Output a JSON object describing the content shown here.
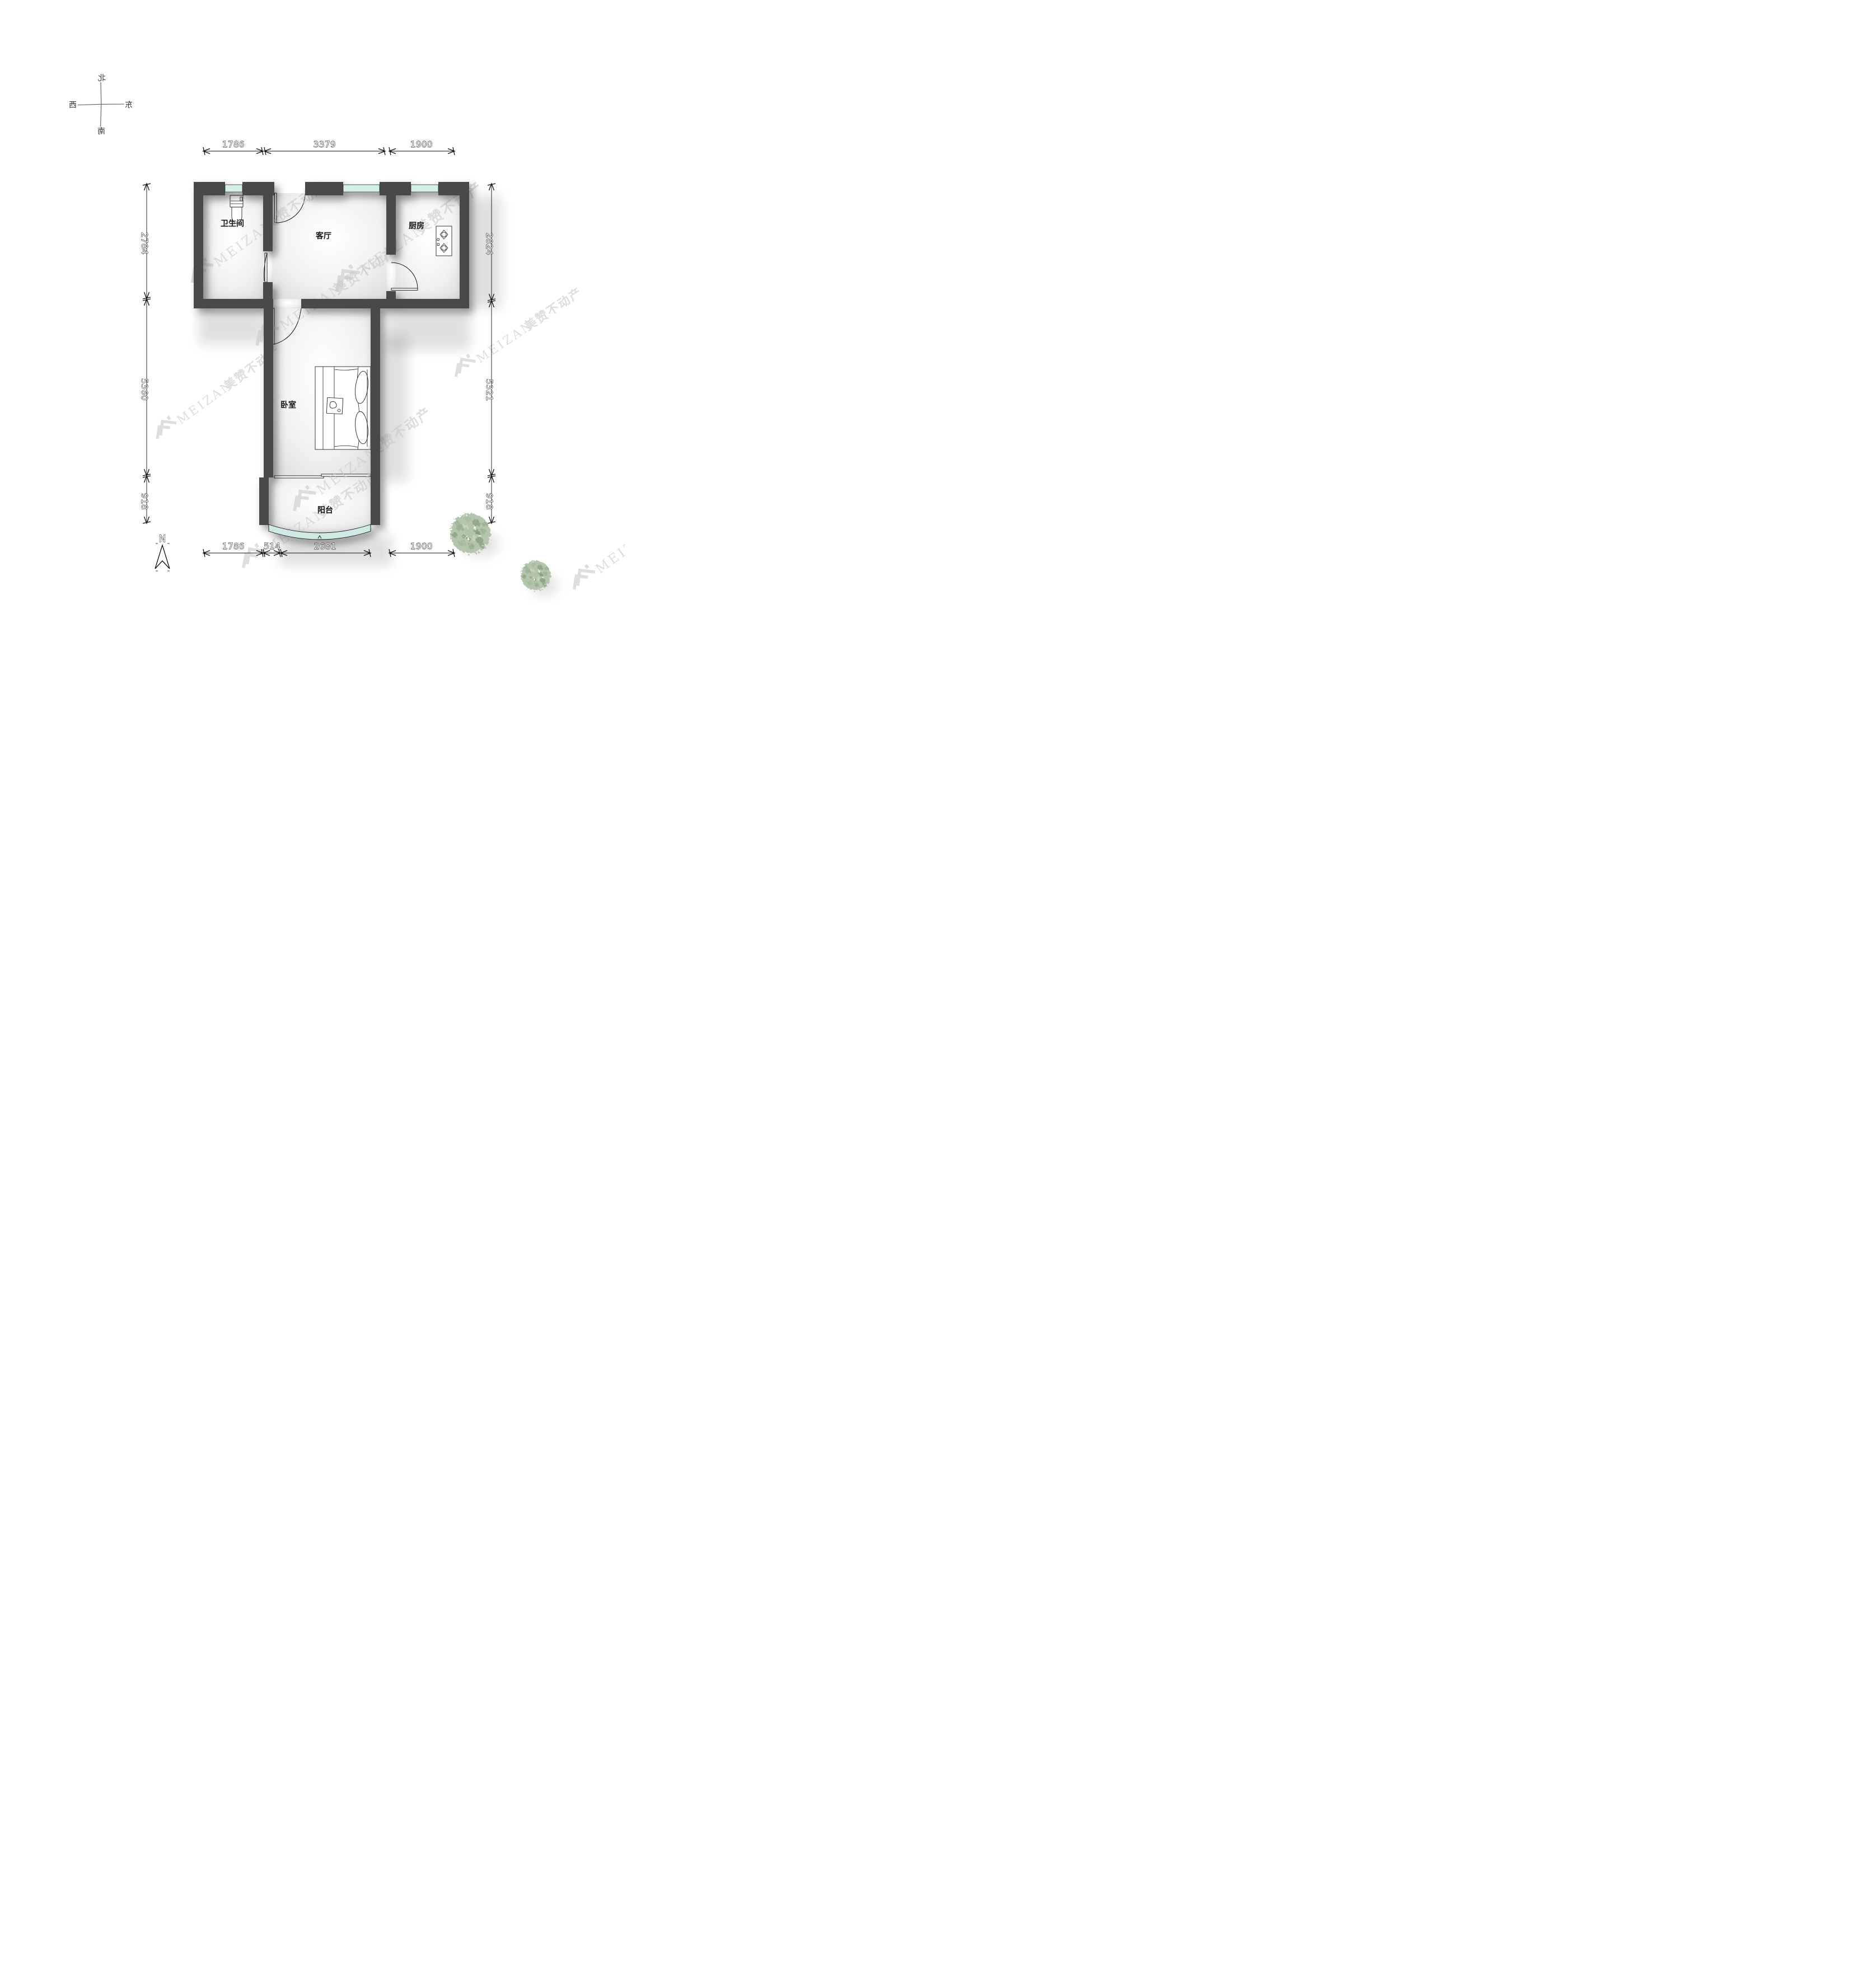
{
  "page": {
    "background": "#ffffff",
    "type": "apartment-floor-plan"
  },
  "compass": {
    "north": "北",
    "south": "南",
    "west": "西",
    "east": "东"
  },
  "rooms": {
    "bathroom": "卫生间",
    "living": "客厅",
    "kitchen": "厨房",
    "bedroom": "卧室",
    "balcony": "阳台"
  },
  "dims": {
    "top": [
      "1786",
      "3379",
      "1900"
    ],
    "bottom": [
      "1786",
      "514",
      "2681",
      "1900"
    ],
    "left": [
      "2784",
      "5360",
      "918"
    ],
    "right": [
      "2824",
      "5321",
      "918"
    ]
  },
  "north_arrow": {
    "label": "N"
  },
  "watermark": {
    "latin": "MEIZAN",
    "cjk": "美赞不动产"
  },
  "colors": {
    "wall": "#4a4a4c",
    "window_glass": "#d6eeea",
    "balcony_glass": "#cfe9e4",
    "tree": "#a8bba0",
    "dimension_text_fill": "#ffffff",
    "dimension_text_stroke": "#000000",
    "watermark": "#c8c8c8"
  }
}
